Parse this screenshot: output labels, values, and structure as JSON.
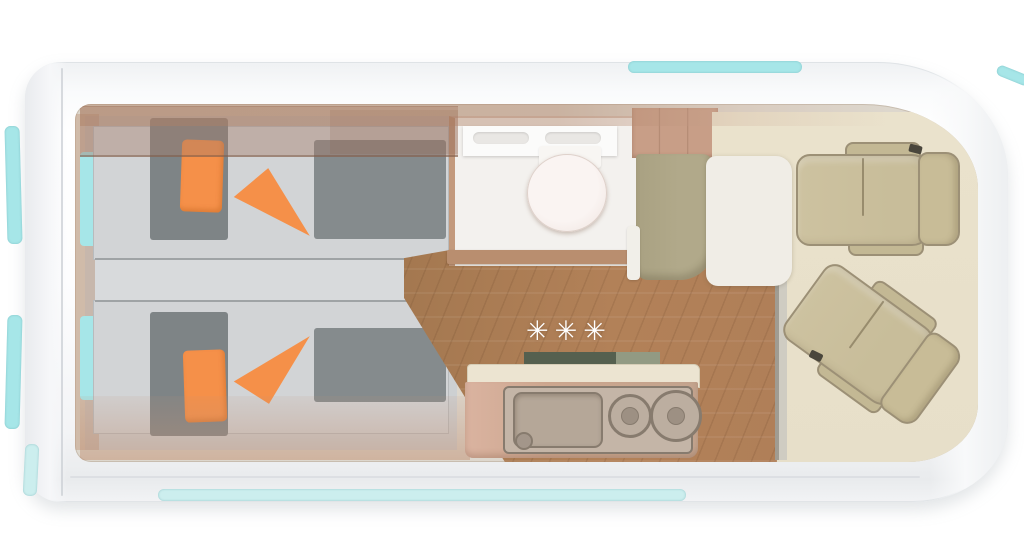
{
  "floorplan": {
    "symbols": {
      "gas_hob": "✳✳✳"
    },
    "colors": {
      "window_cyan": "#a6e6e8",
      "window_cyan_pale": "#cceeee",
      "interior_base": "#ddd7cd",
      "bed_platform": "#d2d4d6",
      "bed_aisle": "#d8dadc",
      "mattress_dark": "#7e8486",
      "accent_orange": "#f59049",
      "wood": "#b28158",
      "wood_dark": "#a47850",
      "bathroom_floor": "#f3f1ee",
      "toilet_white": "#faf4f2",
      "threshold": "#b98e6f",
      "wardrobe": "#c89e87",
      "bench": "#b1a98a",
      "table": "#f0ede6",
      "counter_cream": "#ece4d1",
      "counter_face": "#cda78f",
      "panel": "#c4b5a7",
      "appliance_edge": "#877b6e",
      "backsplash_dark": "#55604f",
      "backsplash_light": "#929a83",
      "cab_floor": "#e7dfc9",
      "seat": "#c8bd9a",
      "seat_edge": "#9c9076",
      "step_gray": "#a09c92"
    }
  }
}
